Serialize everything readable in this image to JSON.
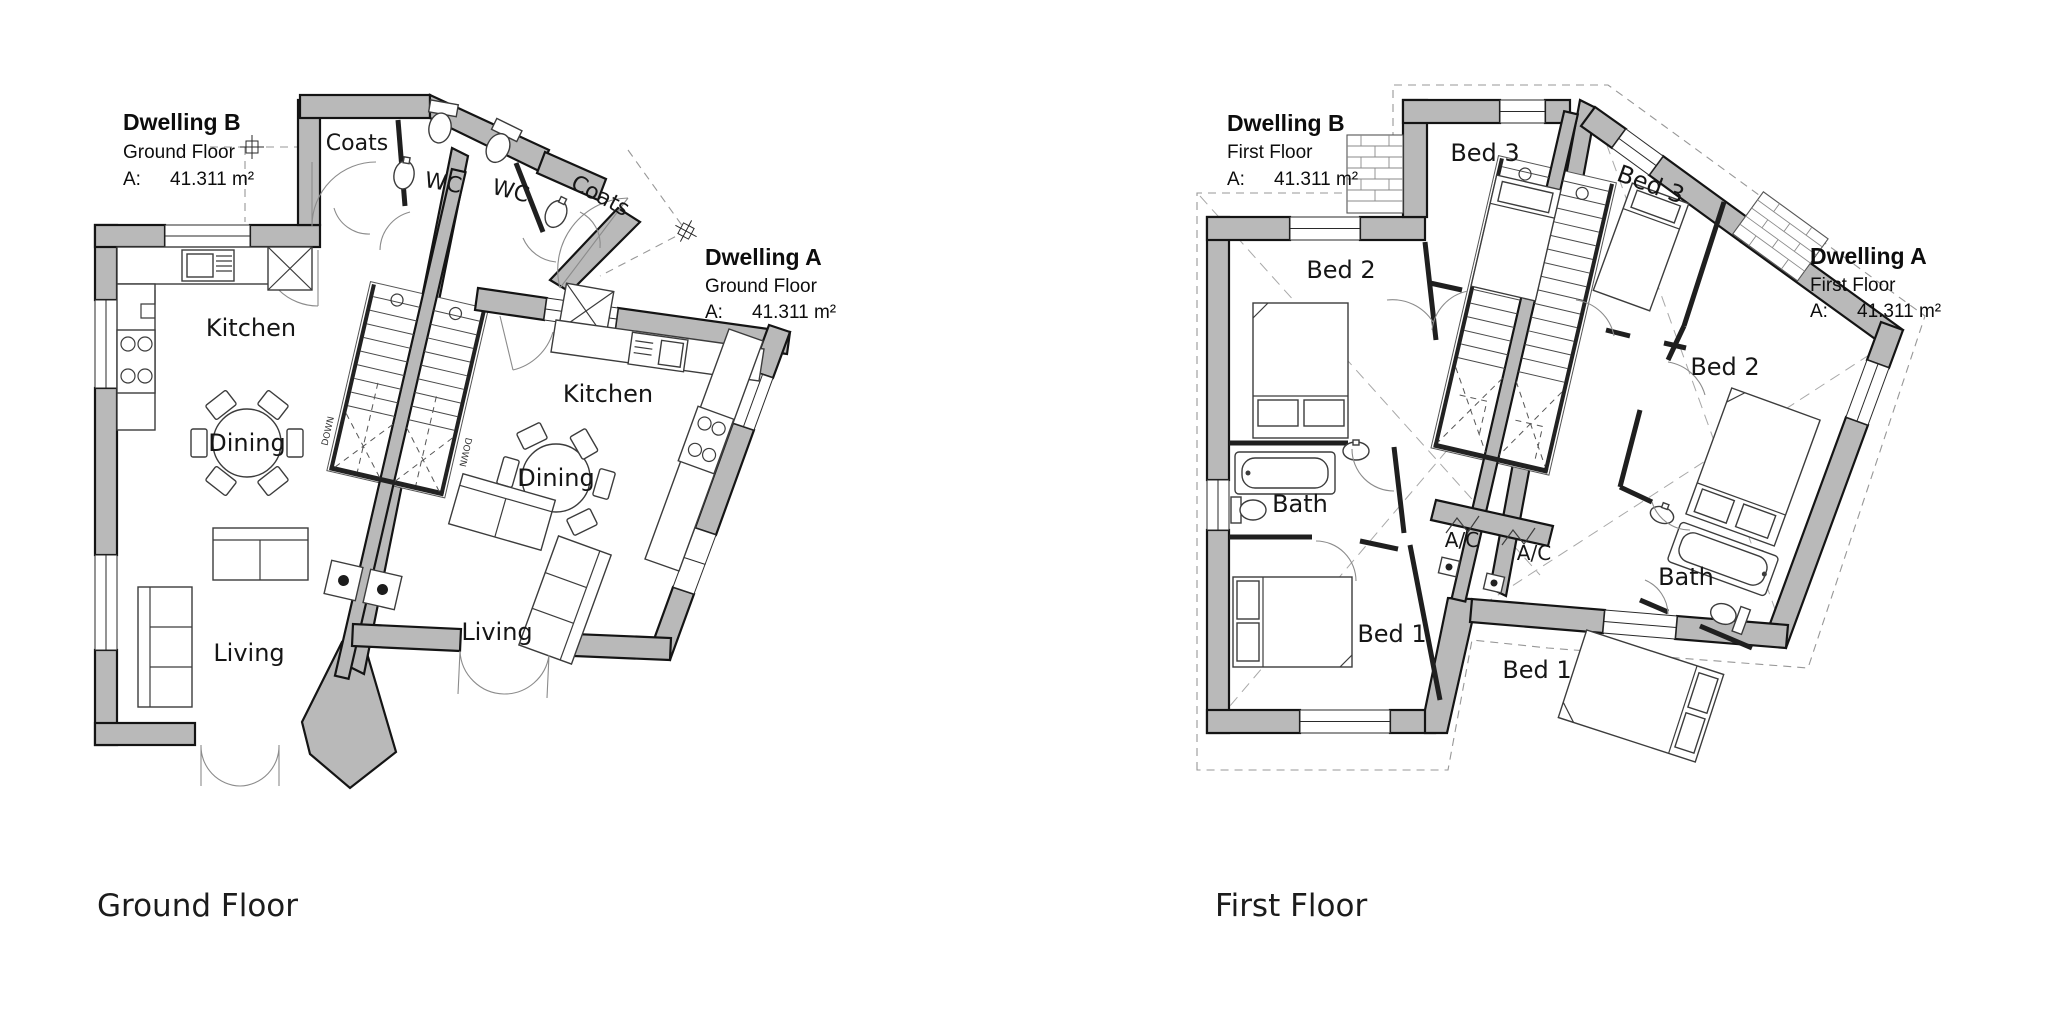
{
  "page": {
    "background": "#ffffff",
    "wall_color": "#b9b9b9",
    "line_color": "#141414"
  },
  "ground_floor": {
    "title": "Ground Floor",
    "dwelling_b": {
      "name": "Dwelling B",
      "floor": "Ground Floor",
      "area_label": "A:",
      "area_value": "41.311 m²"
    },
    "dwelling_a": {
      "name": "Dwelling A",
      "floor": "Ground Floor",
      "area_label": "A:",
      "area_value": "41.311 m²"
    },
    "rooms": {
      "coats_b": "Coats",
      "wc_b": "WC",
      "wc_a": "WC",
      "coats_a": "Coats",
      "kitchen_b": "Kitchen",
      "dining_b": "Dining",
      "living_b": "Living",
      "kitchen_a": "Kitchen",
      "dining_a": "Dining",
      "living_a": "Living",
      "down_b": "DOWN",
      "down_a": "DOWN"
    }
  },
  "first_floor": {
    "title": "First Floor",
    "dwelling_b": {
      "name": "Dwelling B",
      "floor": "First Floor",
      "area_label": "A:",
      "area_value": "41.311 m²"
    },
    "dwelling_a": {
      "name": "Dwelling A",
      "floor": "First Floor",
      "area_label": "A:",
      "area_value": "41.311 m²"
    },
    "rooms": {
      "bed3_b": "Bed 3",
      "bed3_a": "Bed 3",
      "bed2_b": "Bed 2",
      "bed2_a": "Bed 2",
      "bath_b": "Bath",
      "bath_a": "Bath",
      "ac_b": "A/C",
      "ac_a": "A/C",
      "bed1_b": "Bed 1",
      "bed1_a": "Bed 1"
    }
  }
}
